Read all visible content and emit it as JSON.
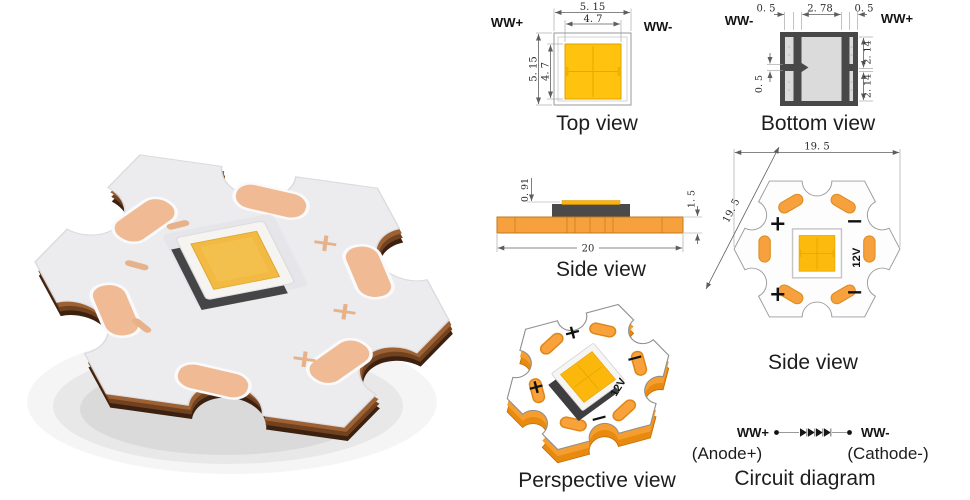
{
  "photo": {
    "plus": "+",
    "minus": "−",
    "colors": {
      "board_white": "#ECECEF",
      "pad_copper": "#F0BB94",
      "edge_copper_dark": "#3C2010",
      "edge_copper_mid": "#70421F",
      "edge_copper_light": "#9E6133",
      "phosphor_yellow": "#F2BA42"
    }
  },
  "views": {
    "top": {
      "title": "Top view",
      "anode": "WW+",
      "cathode": "WW-",
      "dims": {
        "outer_width": "5. 15",
        "inner_width": "4. 7",
        "outer_height": "5. 15",
        "inner_height": "4. 7"
      }
    },
    "bottom": {
      "title": "Bottom view",
      "cathode": "WW-",
      "anode": "WW+",
      "dims": {
        "left_pad": "0. 5",
        "center": "2. 78",
        "right_pad": "0. 5",
        "right_top": "2. 14",
        "right_bottom": "2. 14",
        "left_gap": "0. 5"
      }
    },
    "side": {
      "title": "Side view",
      "dims": {
        "emitter_height": "0. 91",
        "board_width": "20",
        "board_thickness": "1. 5"
      }
    },
    "star": {
      "title": "Side view",
      "voltage": "12V",
      "plus": "+",
      "minus": "−",
      "dims": {
        "width": "19. 5",
        "diagonal": "19. 5"
      }
    },
    "perspective": {
      "title": "Perspective view",
      "voltage": "12V",
      "plus": "+",
      "minus": "−"
    },
    "circuit": {
      "title": "Circuit diagram",
      "anode": "WW+",
      "anode_sub": "(Anode+)",
      "cathode": "WW-",
      "cathode_sub": "(Cathode-)"
    }
  },
  "colors": {
    "drawing_orange": "#F6A13D",
    "led_amber": "#FBBA0C",
    "top_view_yellow": "#FFC20E",
    "package_dark_gray": "#484848",
    "bottom_inner_gray": "#DBDBDB"
  }
}
